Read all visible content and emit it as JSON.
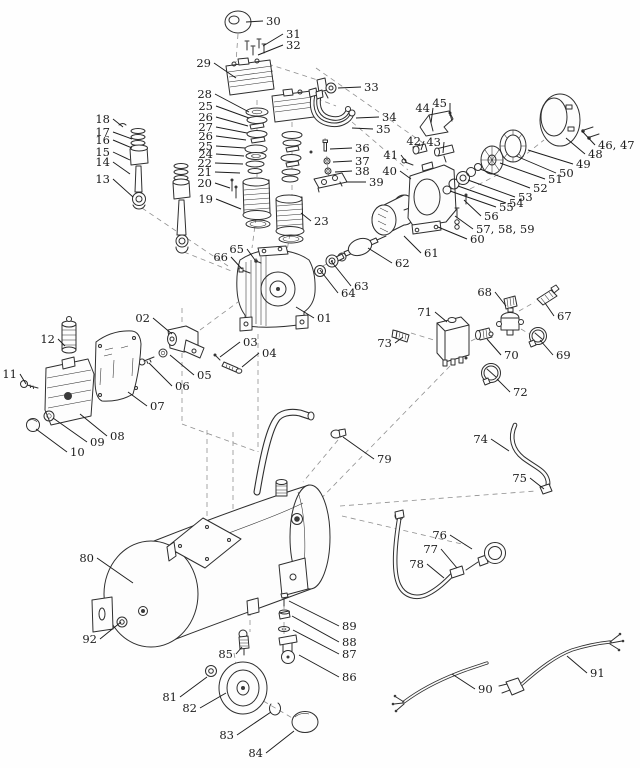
{
  "diagram": {
    "type": "exploded-parts-diagram",
    "subject": "air compressor",
    "colors": {
      "background": "#fefefe",
      "line_art": "#2e2e2e",
      "label_text": "#1c1c1c",
      "guide_dash": "#8f8f8f"
    },
    "label_font_size": 11.5,
    "parts": [
      {
        "id": "01",
        "n": "01",
        "lx": 317,
        "ly": 322,
        "anchor": "start",
        "tx": 296,
        "ty": 307
      },
      {
        "id": "02",
        "n": "02",
        "lx": 150,
        "ly": 322,
        "anchor": "end",
        "tx": 172,
        "ty": 334
      },
      {
        "id": "03",
        "n": "03",
        "lx": 243,
        "ly": 346,
        "anchor": "start",
        "tx": 220,
        "ty": 357
      },
      {
        "id": "04",
        "n": "04",
        "lx": 262,
        "ly": 357,
        "anchor": "start",
        "tx": 242,
        "ty": 367
      },
      {
        "id": "05",
        "n": "05",
        "lx": 197,
        "ly": 379,
        "anchor": "start",
        "tx": 170,
        "ty": 355
      },
      {
        "id": "06",
        "n": "06",
        "lx": 175,
        "ly": 390,
        "anchor": "start",
        "tx": 149,
        "ty": 363
      },
      {
        "id": "07",
        "n": "07",
        "lx": 150,
        "ly": 410,
        "anchor": "start",
        "tx": 128,
        "ty": 392
      },
      {
        "id": "08",
        "n": "08",
        "lx": 110,
        "ly": 440,
        "anchor": "start",
        "tx": 80,
        "ty": 414
      },
      {
        "id": "09",
        "n": "09",
        "lx": 90,
        "ly": 446,
        "anchor": "start",
        "tx": 53,
        "ty": 418
      },
      {
        "id": "10",
        "n": "10",
        "lx": 70,
        "ly": 456,
        "anchor": "start",
        "tx": 36,
        "ty": 429
      },
      {
        "id": "11",
        "n": "11",
        "lx": 17,
        "ly": 378,
        "anchor": "end",
        "tx": 26,
        "ty": 384
      },
      {
        "id": "12",
        "n": "12",
        "lx": 55,
        "ly": 343,
        "anchor": "end",
        "tx": 65,
        "ty": 346
      },
      {
        "id": "13",
        "n": "13",
        "lx": 110,
        "ly": 183,
        "anchor": "end",
        "tx": 133,
        "ty": 197
      },
      {
        "id": "14",
        "n": "14",
        "lx": 110,
        "ly": 166,
        "anchor": "end",
        "tx": 130,
        "ty": 174
      },
      {
        "id": "15",
        "n": "15",
        "lx": 110,
        "ly": 156,
        "anchor": "end",
        "tx": 130,
        "ty": 160
      },
      {
        "id": "16",
        "n": "16",
        "lx": 110,
        "ly": 144,
        "anchor": "end",
        "tx": 132,
        "ty": 148
      },
      {
        "id": "17",
        "n": "17",
        "lx": 110,
        "ly": 136,
        "anchor": "end",
        "tx": 132,
        "ty": 139
      },
      {
        "id": "18",
        "n": "18",
        "lx": 110,
        "ly": 123,
        "anchor": "end",
        "tx": 123,
        "ty": 127
      },
      {
        "id": "19",
        "n": "19",
        "lx": 213,
        "ly": 203,
        "anchor": "end",
        "tx": 241,
        "ty": 209
      },
      {
        "id": "20",
        "n": "20",
        "lx": 212,
        "ly": 187,
        "anchor": "end",
        "tx": 230,
        "ty": 188
      },
      {
        "id": "21",
        "n": "21",
        "lx": 212,
        "ly": 176,
        "anchor": "end",
        "tx": 240,
        "ty": 173
      },
      {
        "id": "22",
        "n": "22",
        "lx": 212,
        "ly": 167,
        "anchor": "end",
        "tx": 243,
        "ty": 164
      },
      {
        "id": "24",
        "n": "24",
        "lx": 213,
        "ly": 158,
        "anchor": "end",
        "tx": 244,
        "ty": 156
      },
      {
        "id": "25a",
        "n": "25",
        "lx": 213,
        "ly": 150,
        "anchor": "end",
        "tx": 245,
        "ty": 148
      },
      {
        "id": "26a",
        "n": "26",
        "lx": 213,
        "ly": 140,
        "anchor": "end",
        "tx": 246,
        "ty": 140
      },
      {
        "id": "27",
        "n": "27",
        "lx": 213,
        "ly": 131,
        "anchor": "end",
        "tx": 247,
        "ty": 133
      },
      {
        "id": "26b",
        "n": "26",
        "lx": 213,
        "ly": 121,
        "anchor": "end",
        "tx": 248,
        "ty": 126
      },
      {
        "id": "25b",
        "n": "25",
        "lx": 213,
        "ly": 110,
        "anchor": "end",
        "tx": 249,
        "ty": 118
      },
      {
        "id": "28",
        "n": "28",
        "lx": 212,
        "ly": 98,
        "anchor": "end",
        "tx": 249,
        "ty": 112
      },
      {
        "id": "23",
        "n": "23",
        "lx": 314,
        "ly": 225,
        "anchor": "start",
        "tx": 301,
        "ty": 213
      },
      {
        "id": "29",
        "n": "29",
        "lx": 211,
        "ly": 67,
        "anchor": "end",
        "tx": 236,
        "ty": 78
      },
      {
        "id": "30",
        "n": "30",
        "lx": 266,
        "ly": 25,
        "anchor": "start",
        "tx": 246,
        "ty": 22
      },
      {
        "id": "31",
        "n": "31",
        "lx": 286,
        "ly": 38,
        "anchor": "start",
        "tx": 263,
        "ty": 46
      },
      {
        "id": "32",
        "n": "32",
        "lx": 286,
        "ly": 49,
        "anchor": "start",
        "tx": 258,
        "ty": 55
      },
      {
        "id": "33",
        "n": "33",
        "lx": 364,
        "ly": 91,
        "anchor": "start",
        "tx": 338,
        "ty": 88
      },
      {
        "id": "34",
        "n": "34",
        "lx": 382,
        "ly": 121,
        "anchor": "start",
        "tx": 356,
        "ty": 118
      },
      {
        "id": "35",
        "n": "35",
        "lx": 376,
        "ly": 133,
        "anchor": "start",
        "tx": 352,
        "ty": 128
      },
      {
        "id": "36",
        "n": "36",
        "lx": 355,
        "ly": 152,
        "anchor": "start",
        "tx": 330,
        "ty": 149
      },
      {
        "id": "37",
        "n": "37",
        "lx": 355,
        "ly": 165,
        "anchor": "start",
        "tx": 333,
        "ty": 162
      },
      {
        "id": "38",
        "n": "38",
        "lx": 355,
        "ly": 175,
        "anchor": "start",
        "tx": 335,
        "ty": 172
      },
      {
        "id": "39",
        "n": "39",
        "lx": 369,
        "ly": 186,
        "anchor": "start",
        "tx": 346,
        "ty": 182
      },
      {
        "id": "40",
        "n": "40",
        "lx": 397,
        "ly": 175,
        "anchor": "end",
        "tx": 411,
        "ty": 179
      },
      {
        "id": "41",
        "n": "41",
        "lx": 398,
        "ly": 159,
        "anchor": "end",
        "tx": 407,
        "ty": 163
      },
      {
        "id": "42",
        "n": "42",
        "lx": 421,
        "ly": 145,
        "anchor": "end",
        "tx": 421,
        "ty": 150
      },
      {
        "id": "43",
        "n": "43",
        "lx": 441,
        "ly": 146,
        "anchor": "end",
        "tx": 443,
        "ty": 153
      },
      {
        "id": "44",
        "n": "44",
        "lx": 430,
        "ly": 112,
        "anchor": "end",
        "tx": 431,
        "ty": 123
      },
      {
        "id": "45",
        "n": "45",
        "lx": 447,
        "ly": 107,
        "anchor": "end",
        "tx": 450,
        "ty": 116
      },
      {
        "id": "46_47",
        "n": "46, 47",
        "lx": 598,
        "ly": 149,
        "anchor": "start",
        "tx": 582,
        "ty": 131
      },
      {
        "id": "48",
        "n": "48",
        "lx": 588,
        "ly": 158,
        "anchor": "start",
        "tx": 566,
        "ty": 138
      },
      {
        "id": "49",
        "n": "49",
        "lx": 576,
        "ly": 168,
        "anchor": "start",
        "tx": 528,
        "ty": 150
      },
      {
        "id": "50",
        "n": "50",
        "lx": 559,
        "ly": 177,
        "anchor": "start",
        "tx": 516,
        "ty": 156
      },
      {
        "id": "51",
        "n": "51",
        "lx": 548,
        "ly": 183,
        "anchor": "start",
        "tx": 500,
        "ty": 163
      },
      {
        "id": "52",
        "n": "52",
        "lx": 533,
        "ly": 192,
        "anchor": "start",
        "tx": 480,
        "ty": 169
      },
      {
        "id": "53",
        "n": "53",
        "lx": 518,
        "ly": 201,
        "anchor": "start",
        "tx": 468,
        "ty": 180
      },
      {
        "id": "54",
        "n": "54",
        "lx": 509,
        "ly": 207,
        "anchor": "start",
        "tx": 458,
        "ty": 186
      },
      {
        "id": "55",
        "n": "55",
        "lx": 499,
        "ly": 211,
        "anchor": "start",
        "tx": 450,
        "ty": 191
      },
      {
        "id": "56",
        "n": "56",
        "lx": 484,
        "ly": 220,
        "anchor": "start",
        "tx": 464,
        "ty": 200
      },
      {
        "id": "57_58_59",
        "n": "57, 58, 59",
        "lx": 476,
        "ly": 233,
        "anchor": "start",
        "tx": 455,
        "ty": 216
      },
      {
        "id": "60",
        "n": "60",
        "lx": 470,
        "ly": 243,
        "anchor": "start",
        "tx": 438,
        "ty": 227
      },
      {
        "id": "61",
        "n": "61",
        "lx": 424,
        "ly": 257,
        "anchor": "start",
        "tx": 404,
        "ty": 236
      },
      {
        "id": "62",
        "n": "62",
        "lx": 395,
        "ly": 267,
        "anchor": "start",
        "tx": 368,
        "ty": 248
      },
      {
        "id": "63",
        "n": "63",
        "lx": 354,
        "ly": 290,
        "anchor": "start",
        "tx": 331,
        "ty": 261
      },
      {
        "id": "64",
        "n": "64",
        "lx": 341,
        "ly": 297,
        "anchor": "start",
        "tx": 320,
        "ty": 270
      },
      {
        "id": "65",
        "n": "65",
        "lx": 244,
        "ly": 253,
        "anchor": "end",
        "tx": 255,
        "ty": 260
      },
      {
        "id": "66",
        "n": "66",
        "lx": 228,
        "ly": 261,
        "anchor": "end",
        "tx": 242,
        "ty": 269
      },
      {
        "id": "67",
        "n": "67",
        "lx": 557,
        "ly": 320,
        "anchor": "start",
        "tx": 545,
        "ty": 303
      },
      {
        "id": "68",
        "n": "68",
        "lx": 492,
        "ly": 296,
        "anchor": "end",
        "tx": 506,
        "ty": 306
      },
      {
        "id": "69",
        "n": "69",
        "lx": 556,
        "ly": 359,
        "anchor": "start",
        "tx": 540,
        "ty": 340
      },
      {
        "id": "70",
        "n": "70",
        "lx": 504,
        "ly": 359,
        "anchor": "start",
        "tx": 487,
        "ty": 339
      },
      {
        "id": "71",
        "n": "71",
        "lx": 432,
        "ly": 316,
        "anchor": "end",
        "tx": 447,
        "ty": 322
      },
      {
        "id": "72",
        "n": "72",
        "lx": 513,
        "ly": 396,
        "anchor": "start",
        "tx": 497,
        "ty": 379
      },
      {
        "id": "73",
        "n": "73",
        "lx": 392,
        "ly": 347,
        "anchor": "end",
        "tx": 403,
        "ty": 337
      },
      {
        "id": "74",
        "n": "74",
        "lx": 488,
        "ly": 443,
        "anchor": "end",
        "tx": 509,
        "ty": 451
      },
      {
        "id": "75",
        "n": "75",
        "lx": 527,
        "ly": 482,
        "anchor": "end",
        "tx": 544,
        "ty": 489
      },
      {
        "id": "76",
        "n": "76",
        "lx": 447,
        "ly": 539,
        "anchor": "end",
        "tx": 472,
        "ty": 549
      },
      {
        "id": "77",
        "n": "77",
        "lx": 438,
        "ly": 553,
        "anchor": "end",
        "tx": 457,
        "ty": 568
      },
      {
        "id": "78",
        "n": "78",
        "lx": 424,
        "ly": 568,
        "anchor": "end",
        "tx": 444,
        "ty": 578
      },
      {
        "id": "79",
        "n": "79",
        "lx": 377,
        "ly": 463,
        "anchor": "start",
        "tx": 343,
        "ty": 437
      },
      {
        "id": "80",
        "n": "80",
        "lx": 94,
        "ly": 562,
        "anchor": "end",
        "tx": 133,
        "ty": 583
      },
      {
        "id": "81",
        "n": "81",
        "lx": 177,
        "ly": 701,
        "anchor": "end",
        "tx": 207,
        "ty": 677
      },
      {
        "id": "82",
        "n": "82",
        "lx": 197,
        "ly": 712,
        "anchor": "end",
        "tx": 226,
        "ty": 693
      },
      {
        "id": "83",
        "n": "83",
        "lx": 234,
        "ly": 739,
        "anchor": "end",
        "tx": 271,
        "ty": 712
      },
      {
        "id": "84",
        "n": "84",
        "lx": 263,
        "ly": 757,
        "anchor": "end",
        "tx": 294,
        "ty": 731
      },
      {
        "id": "85",
        "n": "85",
        "lx": 233,
        "ly": 658,
        "anchor": "end",
        "tx": 242,
        "ty": 647
      },
      {
        "id": "86",
        "n": "86",
        "lx": 342,
        "ly": 681,
        "anchor": "start",
        "tx": 299,
        "ty": 655
      },
      {
        "id": "87",
        "n": "87",
        "lx": 342,
        "ly": 658,
        "anchor": "start",
        "tx": 293,
        "ty": 630
      },
      {
        "id": "88",
        "n": "88",
        "lx": 342,
        "ly": 646,
        "anchor": "start",
        "tx": 292,
        "ty": 616
      },
      {
        "id": "89",
        "n": "89",
        "lx": 342,
        "ly": 630,
        "anchor": "start",
        "tx": 289,
        "ty": 601
      },
      {
        "id": "90",
        "n": "90",
        "lx": 478,
        "ly": 693,
        "anchor": "start",
        "tx": 452,
        "ty": 674
      },
      {
        "id": "91",
        "n": "91",
        "lx": 590,
        "ly": 677,
        "anchor": "start",
        "tx": 567,
        "ty": 656
      },
      {
        "id": "92",
        "n": "92",
        "lx": 97,
        "ly": 643,
        "anchor": "end",
        "tx": 121,
        "ty": 622
      }
    ]
  }
}
